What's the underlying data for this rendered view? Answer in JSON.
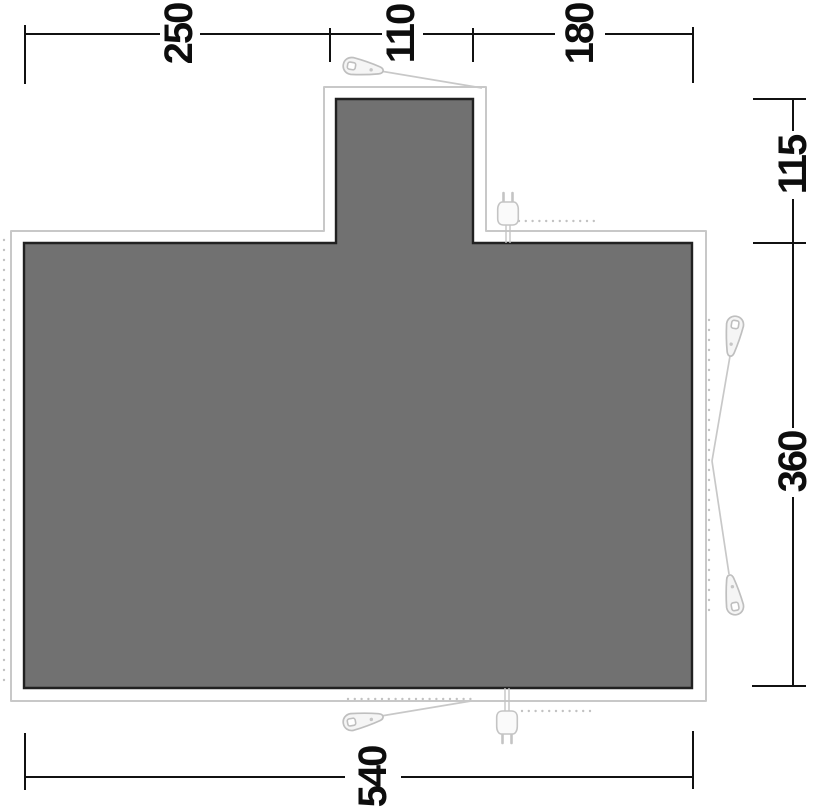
{
  "diagram": {
    "type": "tent-floorplan-dimension-diagram",
    "background_color": "#ffffff",
    "footprint_fill_color": "#717171",
    "footprint_border_color": "#212121",
    "groundsheet_outline_color": "#c8c8c8",
    "dimension_line_color": "#111111",
    "accessory_icon_color": "#c4c4c4"
  },
  "dims": {
    "top": [
      {
        "value": "250"
      },
      {
        "value": "110"
      },
      {
        "value": "180"
      }
    ],
    "right": [
      {
        "value": "115"
      },
      {
        "value": "360"
      }
    ],
    "bottom": [
      {
        "value": "540"
      }
    ]
  },
  "icons": [
    {
      "name": "guy-peg-icon-top"
    },
    {
      "name": "guy-peg-icon-bottom-left"
    },
    {
      "name": "guy-peg-icon-right-upper"
    },
    {
      "name": "guy-peg-icon-right-lower"
    },
    {
      "name": "power-plug-icon-top"
    },
    {
      "name": "power-plug-icon-bottom"
    }
  ]
}
